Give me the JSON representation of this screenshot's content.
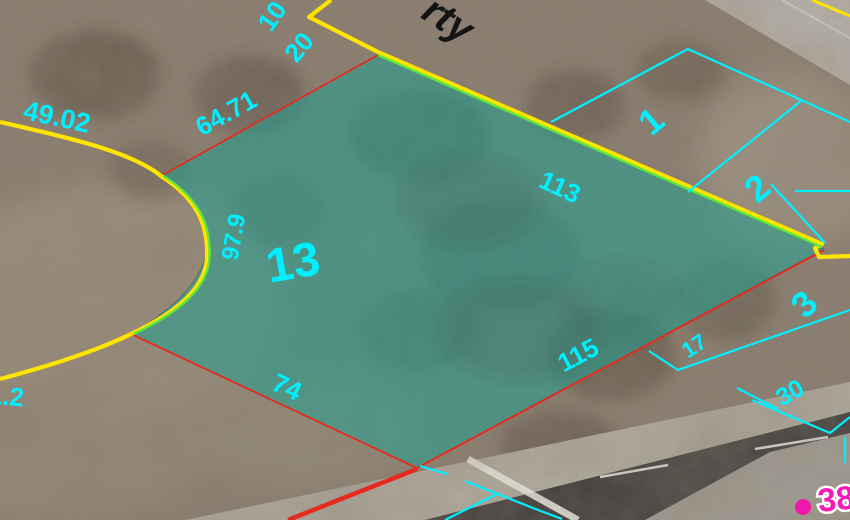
{
  "map": {
    "view": "parcel-viewer-aerial",
    "street_label_fragment": "rty",
    "address_label": "38",
    "selected_parcel": {
      "number": "13",
      "dimensions": {
        "northwest_edge": "64.71",
        "northeast_edge": "113",
        "southeast_edge": "115",
        "southwest_edge": "74",
        "west_arc_chord": "97.9"
      }
    },
    "adjacent_parcel_numbers": [
      "1",
      "2",
      "3"
    ],
    "dimension_labels": {
      "top_first": "10",
      "top_second": "20",
      "culdesac": "49.02",
      "left_edge_clipped": "1.2",
      "east_short": "17",
      "east_long": "30"
    },
    "colors": {
      "highlight_fill": "rgba(32,160,146,0.55)",
      "dimension_text": "#00F0FF",
      "parcel_line": "#00F0FF",
      "road_casing_yellow": "#FFE400",
      "lot_line_red": "#E62B1E",
      "lot_line_green": "#5FE83A",
      "street_text": "#141414",
      "address_text": "#F619B8",
      "address_dot": "#EE18AD"
    }
  }
}
